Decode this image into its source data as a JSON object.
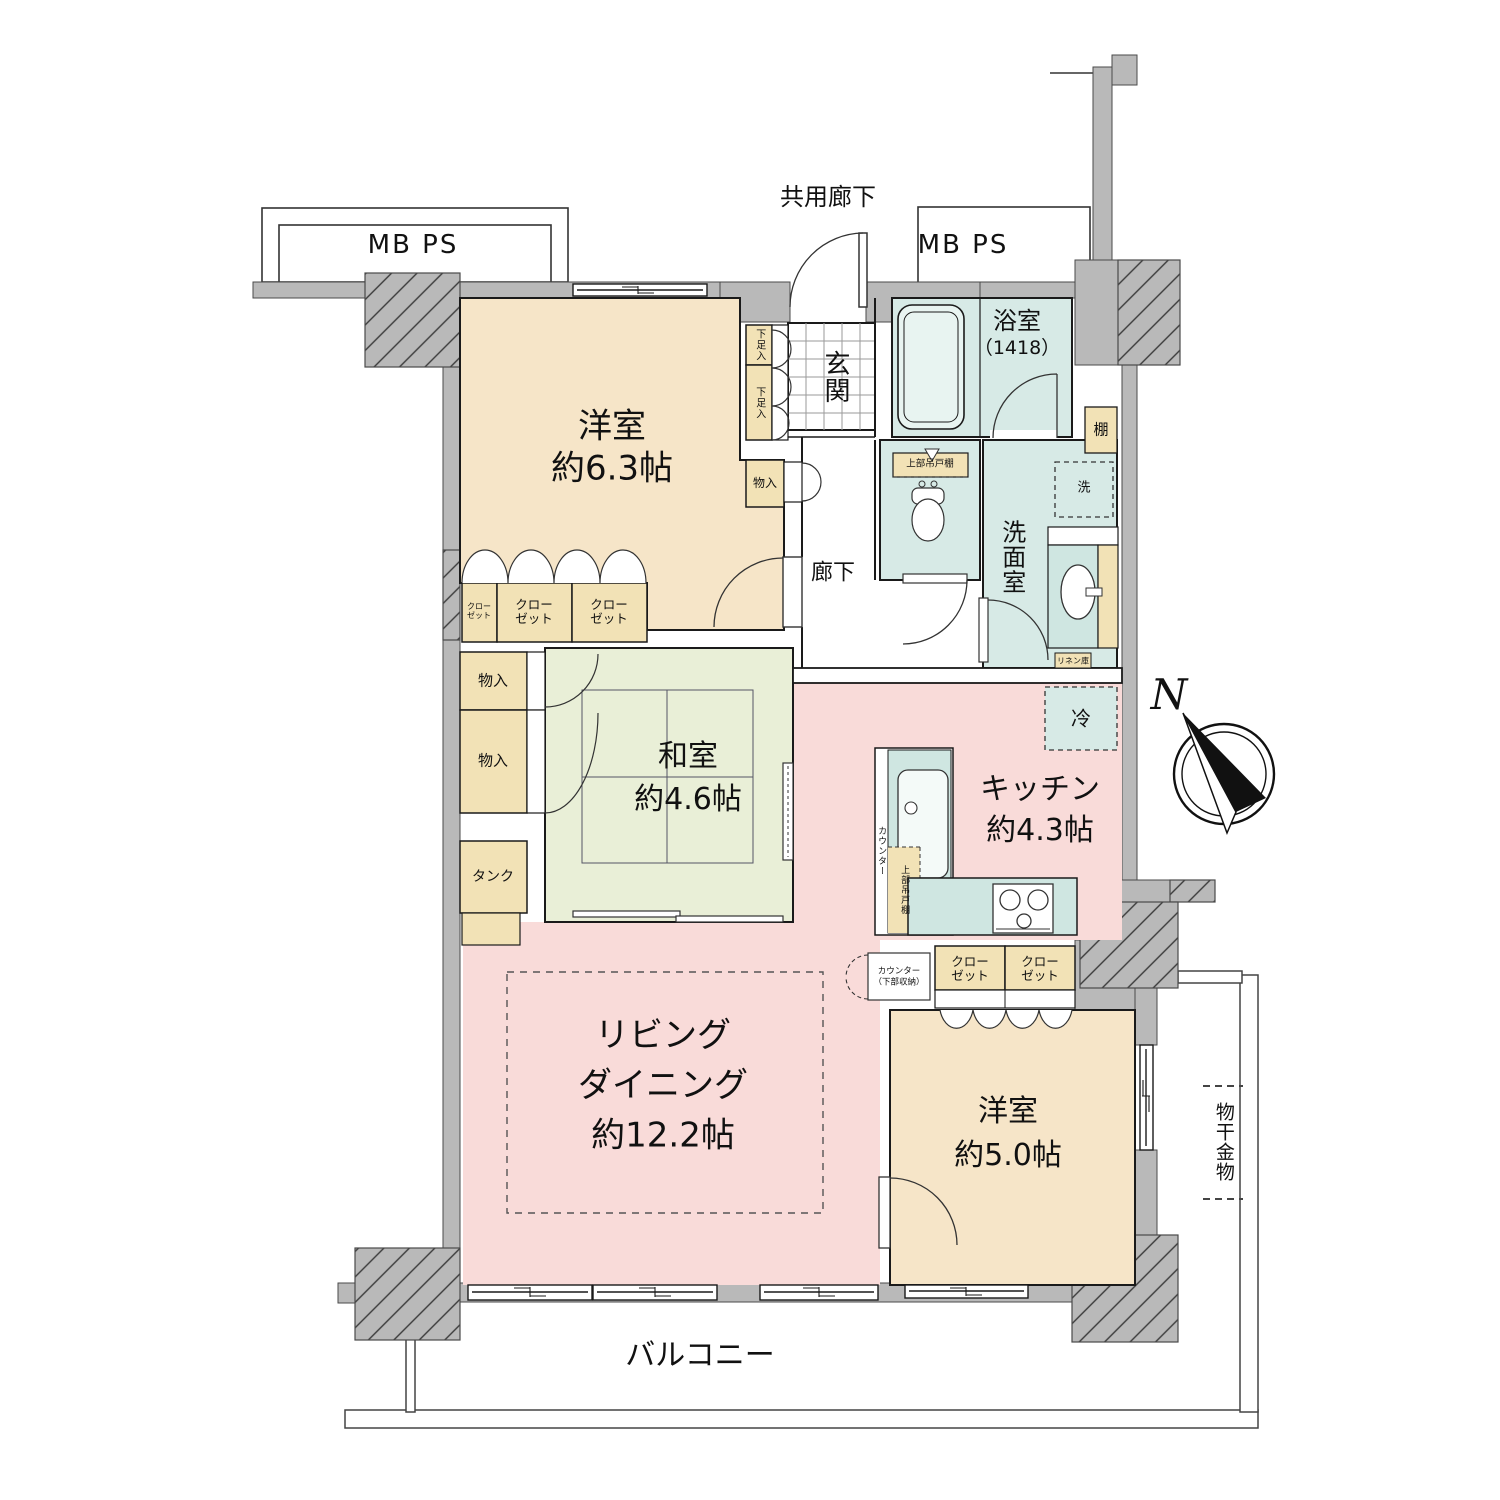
{
  "palette": {
    "wall": "#b9b9b9",
    "room_beige": "#f6e5c8",
    "storage_cream": "#f2e2b6",
    "tatami_green": "#e9efd7",
    "living_pink": "#f9dbd9",
    "wet_teal": "#d7eae6",
    "line": "#1a1a1a"
  },
  "exterior": {
    "common_corridor": "共用廊下",
    "mb_ps_left": "MB PS",
    "mb_ps_right": "MB PS",
    "balcony": "バルコニー",
    "drying_hardware": "物干金物",
    "compass_north": "N"
  },
  "rooms": {
    "western_63": {
      "name": "洋室",
      "size": "約6.3帖"
    },
    "western_50": {
      "name": "洋室",
      "size": "約5.0帖"
    },
    "japanese": {
      "name": "和室",
      "size": "約4.6帖"
    },
    "living": {
      "line1": "リビング",
      "line2": "ダイニング",
      "size": "約12.2帖"
    },
    "kitchen": {
      "name": "キッチン",
      "size": "約4.3帖"
    },
    "bath": {
      "name": "浴室",
      "size": "（1418）"
    },
    "washroom": "洗面室",
    "entrance": "玄関",
    "hallway": "廊下"
  },
  "storage": {
    "shoe_upper": "下足入",
    "shoe_lower": "下足入",
    "hall_storage": "物入",
    "closet_small": "クローゼット",
    "closet_mid": "クローゼット",
    "closet_right": "クローゼット",
    "storage_upper": "物入",
    "storage_lower": "物入",
    "tank": "タンク",
    "shelf": "棚",
    "linen": "リネン庫",
    "closet_kitchen_left": "クローゼット",
    "closet_kitchen_right": "クローゼット"
  },
  "fixtures": {
    "washer": "洗",
    "fridge": "冷",
    "toilet_upper_cabinet": "上部吊戸棚",
    "kitchen_upper_cabinet": "上部吊戸棚",
    "counter": "カウンター",
    "counter_lower_1": "カウンター",
    "counter_lower_2": "（下部収納）"
  }
}
